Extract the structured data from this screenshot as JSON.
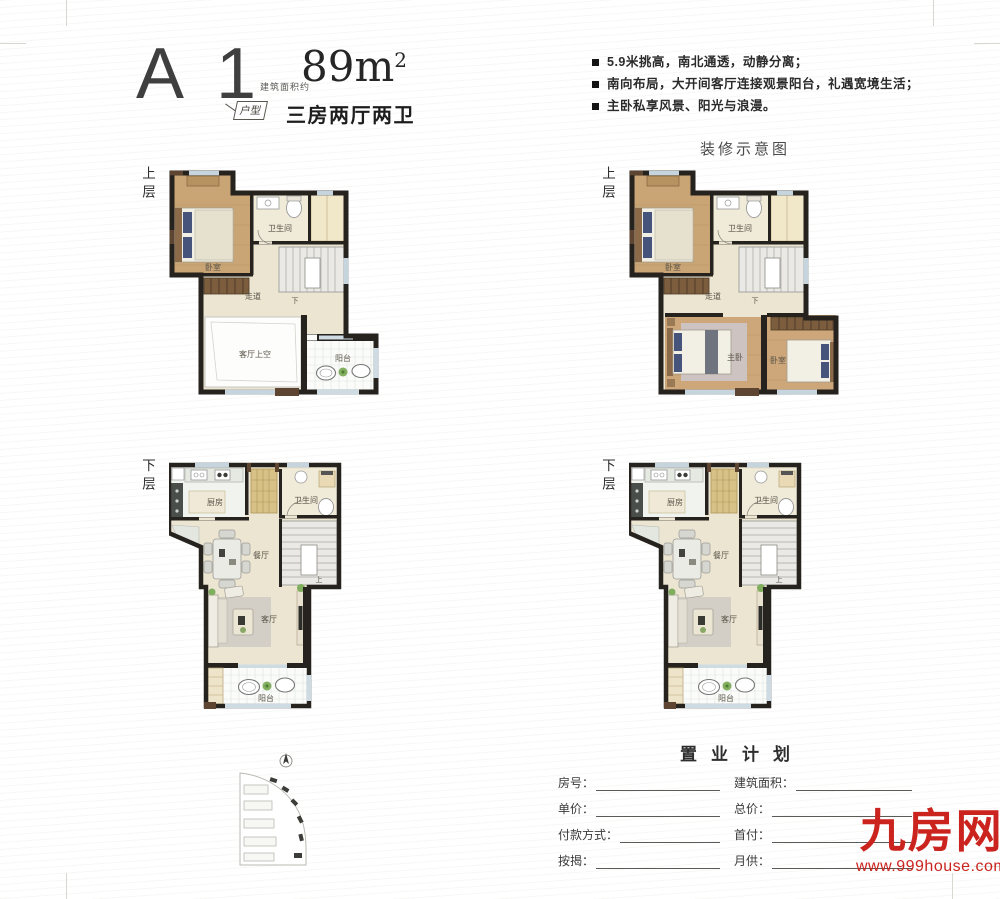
{
  "header": {
    "unit_code": "A 1",
    "unit_tag": "户型",
    "area_prefix": "建筑面积约",
    "area_value": "89m",
    "area_sup": "2",
    "layout": "三房两厅两卫"
  },
  "features": [
    "5.9米挑高，南北通透，动静分离；",
    "南向布局，大开间客厅连接观景阳台，礼遇宽境生活；",
    "主卧私享风景、阳光与浪漫。"
  ],
  "decor_title": "装修示意图",
  "floors": {
    "upper": "上层",
    "lower": "下层"
  },
  "rooms": {
    "bedroom": "卧室",
    "master": "主卧",
    "bathroom": "卫生间",
    "corridor": "走道",
    "living_void": "客厅上空",
    "balcony": "阳台",
    "kitchen": "厨房",
    "dining": "餐厅",
    "living": "客厅",
    "stair_down": "下",
    "stair_up": "上"
  },
  "form": {
    "title": "置业计划",
    "rows": [
      {
        "left": "房号：",
        "right": "建筑面积："
      },
      {
        "left": "单价：",
        "right": "总价："
      },
      {
        "left": "付款方式：",
        "right": "首付："
      },
      {
        "left": "按揭：",
        "right": "月供："
      }
    ]
  },
  "brand": {
    "name": "九房网",
    "site": "www.999house.com",
    "color": "#cb241e"
  }
}
